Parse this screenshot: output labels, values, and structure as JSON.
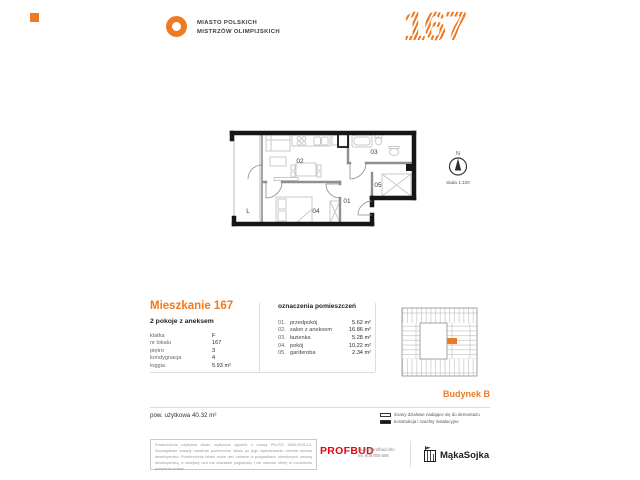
{
  "colors": {
    "orange": "#EE7A25",
    "red": "#E30613",
    "wall_black": "#161616",
    "wall_gray": "#8f8f8f"
  },
  "header": {
    "logo_line1": "MIASTO POLSKICH",
    "logo_line2": "MISTRZÓW OLIMPIJSKICH",
    "unit_number": "167"
  },
  "compass": {
    "north_label": "N",
    "scale_label": "skala 1:100"
  },
  "floor_plan": {
    "labels": {
      "loggia": "L",
      "r01": "01",
      "r02": "02",
      "r03": "03",
      "r04": "04",
      "r05": "05"
    }
  },
  "apartment": {
    "title": "Mieszkanie 167",
    "subtitle": "2 pokoje z aneksem",
    "details": [
      {
        "label": "klatka",
        "value": "F"
      },
      {
        "label": "nr lokalu",
        "value": "167"
      },
      {
        "label": "piętro",
        "value": "3"
      },
      {
        "label": "kondygnacja",
        "value": "4"
      },
      {
        "label": "loggia",
        "value": "5.93 m²"
      }
    ]
  },
  "rooms": {
    "heading": "oznaczenia pomieszczeń",
    "items": [
      {
        "no": "01.",
        "name": "przedpokój",
        "area": "5.62 m²"
      },
      {
        "no": "02.",
        "name": "salon z aneksem",
        "area": "16.86 m²"
      },
      {
        "no": "03.",
        "name": "łazienka",
        "area": "5.28 m²"
      },
      {
        "no": "04.",
        "name": "pokój",
        "area": "10.22 m²"
      },
      {
        "no": "05.",
        "name": "garderoba",
        "area": "2.34 m²"
      }
    ]
  },
  "site": {
    "building_label": "Budynek B"
  },
  "summary": {
    "usable_area_label": "pow. użytkowa",
    "usable_area_value": "40.32 m²"
  },
  "legend": {
    "items": [
      {
        "swatch": "outline",
        "label": "ściany działowe nadające się do demontażu"
      },
      {
        "swatch": "solid",
        "label": "konstrukcja i szachty instalacyjne"
      }
    ]
  },
  "footer": {
    "disclaimer": "Powierzchnia użytkowa lokalu wyliczona zgodnie z normą PN-ISO 9836:2015-12. Szczegółowe zasady ustalenia powierzchni lokalu po jego wybudowaniu określa umowa deweloperska. Powierzchnia lokalu może ulec zmianie w przypadkach określonych umową deweloperską, a niniejszy rzut ma charakter poglądowy i nie stanowi oferty w rozumieniu przepisów prawa.",
    "developer": "PROFBUD",
    "email": "biuro@profbud.info",
    "phone": "tel. 605 606 606",
    "architect": "MąkaSojka"
  }
}
